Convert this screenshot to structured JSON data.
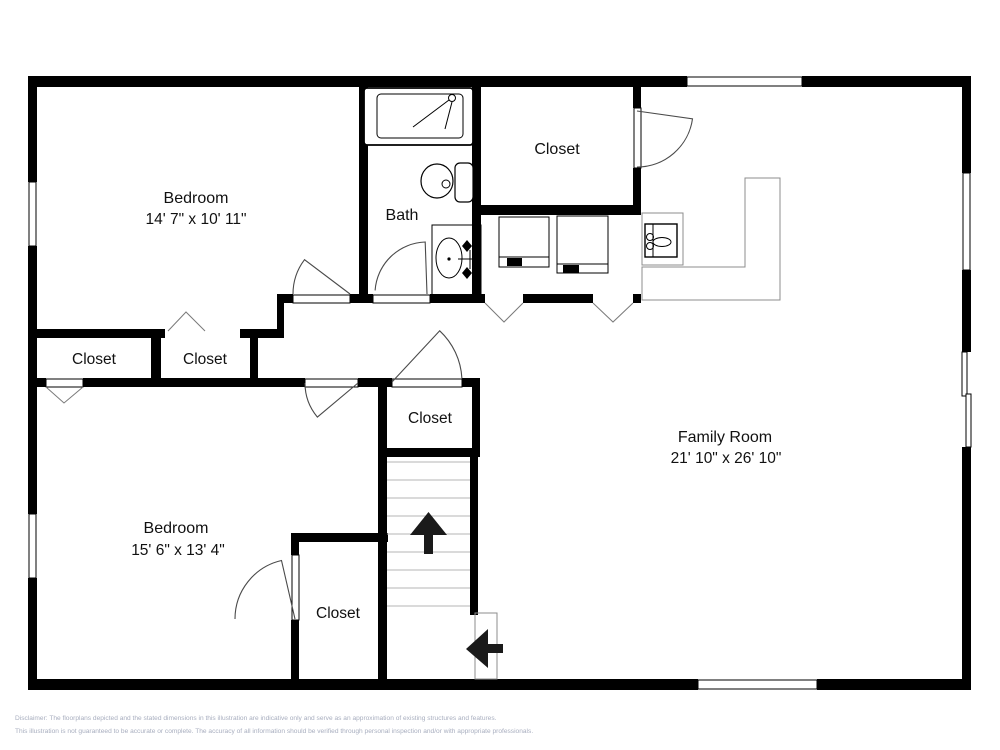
{
  "labels": {
    "bedroom_top": {
      "name": "Bedroom",
      "dims": "14' 7\" x 10' 11\""
    },
    "bath": {
      "name": "Bath"
    },
    "closet_top": {
      "name": "Closet"
    },
    "closet_hall_left": {
      "name": "Closet"
    },
    "closet_hall_right": {
      "name": "Closet"
    },
    "closet_center": {
      "name": "Closet"
    },
    "family_room": {
      "name": "Family Room",
      "dims": "21' 10\" x 26' 10\""
    },
    "bedroom_bottom": {
      "name": "Bedroom",
      "dims": "15' 6\" x 13' 4\""
    },
    "closet_bottom": {
      "name": "Closet"
    }
  },
  "disclaimer": {
    "line1": "Disclaimer: The floorplans depicted and the stated dimensions in this illustration are indicative only and serve as an approximation of existing structures and features.",
    "line2": "This illustration is not guaranteed to be accurate or complete. The accuracy of all information should be verified through personal inspection and/or with appropriate professionals."
  },
  "icons": {
    "fixtures": [
      "bathtub-icon",
      "shower-head-icon",
      "toilet-icon",
      "vanity-sink-icon",
      "washer-icon",
      "dryer-icon",
      "utility-sink-icon",
      "counter-icon",
      "staircase-icon"
    ],
    "arrows": [
      "stairs-up-arrow-icon",
      "entry-left-arrow-icon"
    ]
  },
  "colors": {
    "wall": "#000000",
    "line_gray": "#8c8c8c",
    "text": "#111111",
    "disclaimer_text": "#a8aebf",
    "background": "#ffffff"
  }
}
